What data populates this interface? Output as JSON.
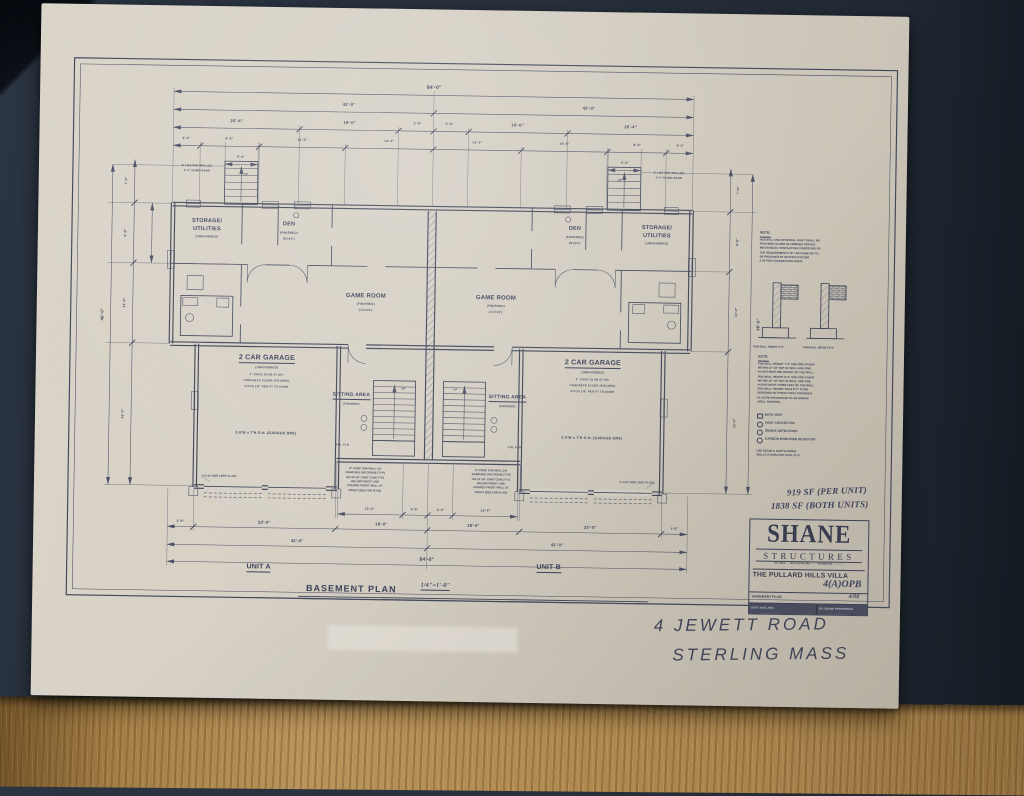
{
  "plan": {
    "title": "BASEMENT PLAN",
    "scale": "1/4\"=1'-0\"",
    "unit_a": "UNIT A",
    "unit_b": "UNIT B"
  },
  "rooms": {
    "storage_1": "STORAGE/",
    "storage_2": "UTILITIES",
    "storage_3": "(UNFINISHED)",
    "den_1": "DEN",
    "den_2": "(FINISHED)",
    "den_3": "(9'x10')",
    "game_1": "GAME ROOM",
    "game_2": "(FINISHED)",
    "game_3": "(14'x12')",
    "garage_1": "2 CAR GARAGE",
    "garage_2": "(UNFINISHED)",
    "garage_n1": "4\" CONC SLAB AT GR.",
    "garage_n2": "CONCRETE FLOOR (PITCHED)",
    "garage_n3": "PITCH 1/8\" PER FT TO DOOR",
    "garage_door": "2-9'W x 7'H O.H. (GARAGE DRS)",
    "sitting_1": "SITTING AREA",
    "sitting_2": "(FINISHED)",
    "fin_flr": "FIN. FLR",
    "up": "UP",
    "hdr_note": "2-2x10 HDR (SEE PLAN)",
    "pier_note_1": "8' LNG PAD WALL(S)",
    "pier_note_2": "4'-0\" DOWN BAND"
  },
  "fdn_note": [
    "8\" CONC FDN WALL (4')",
    "DOWN BELOW GRADE (TYP)",
    "ON 16\"x8\" CONT CONC FTG",
    "BELOW FROST LINE",
    "POURED FROST WALL AT",
    "FRONT (SEE FDN PLAN)"
  ],
  "dims": {
    "d84": "84'-0\"",
    "d42": "42'-0\"",
    "d20_4": "20'-4\"",
    "d16_0": "16'-0\"",
    "d5_8": "5'-8\"",
    "d4_4": "4'-4\"",
    "d9_6": "9'-6\"",
    "d14_0": "14'-0\"",
    "d14_2": "14'-2\"",
    "d5_4": "5'-4\"",
    "d1_6": "1'-6\"",
    "d22_0": "22'-0\"",
    "d18_0": "18'-0\"",
    "d13_0": "13'-0\"",
    "d4_0": "4'-0\"",
    "d46_0": "46'-0\"",
    "d7_0": "7'-0\"",
    "d9_8": "9'-8\"",
    "d23_0": "23'-0\""
  },
  "notes": {
    "note_title": "NOTE:",
    "note1": [
      "NATURAL AND ARTIFICIAL LIGHT SHALL BE",
      "PROVIDED ALONG W/ FINISHED SPACES.",
      "MECHANICAL VENTILATION CONSISTING OF",
      "THE REQUIREMENTS OF THE GAME RM TO",
      "BE PROVIDED BY HEATING SYSTEM",
      "2 SF PER CHANGES PER HOUR."
    ],
    "detail1_label": "FDN WALL HEIGHT 7'-0\"",
    "detail2_label": "FDN WALL HEIGHT 8'-0\"",
    "note2": [
      "FDN WALL HEIGHT 7'-0\" USE ONE #4 BAR",
      "WITHIN 12\" OF TOP OF WALL AND ONE",
      "#4 BAR NEAR MID HEIGHT OF THE WALL.",
      "FDN WALL HEIGHT 8'-0\" USE ONE #4 BAR",
      "WITHIN 12\" OF TOP OF WALL AND ONE",
      "#4 BAR NEAR THREE FEET OF THE WALL.",
      "FDN WALL HIGHER THAN 8'-0\" TO BE",
      "DESIGNED BY STRUCTURAL ENGINEER.",
      "PLASTER HEADROOM TO ADJOINING",
      "AREA, FINISHED."
    ],
    "legend": [
      {
        "icon": "bath-vent-square-icon",
        "label": "BATH VENT"
      },
      {
        "icon": "heat-convector-circle-icon",
        "label": "HEAT CONVECTOR"
      },
      {
        "icon": "smoke-detector-circle-icon",
        "label": "SMOKE DETECTORS"
      },
      {
        "icon": "co-detector-circle-icon",
        "label": "CARBON MONOXIDE DETECTOR"
      }
    ],
    "legend_footer": [
      "USE DOUBLE JOISTS UNDER",
      "WALLS IF GREATER THAN 12'-0\""
    ]
  },
  "annotations": {
    "sf_per_unit": "919 SF (PER UNIT)",
    "sf_both": "1838 SF (BOTH UNITS)",
    "address_1": "4 JEWETT ROAD",
    "address_2": "STERLING MASS"
  },
  "titleblock": {
    "brand_1": "SHANE",
    "brand_2": "STRUCTURES",
    "address": "P.O. BOX ·· · BOYLSTON, MA ····· · PHONE/FAX ···-···-····",
    "project": "THE PULLARD HILLS VILLA",
    "job_no": "4(A)OPB",
    "sheet_name": "BASEMENT PLAN",
    "sheet_no": "4/08",
    "date": "DATE: NOV, 2004",
    "by": "BY: SHANE PROPERTIES"
  }
}
